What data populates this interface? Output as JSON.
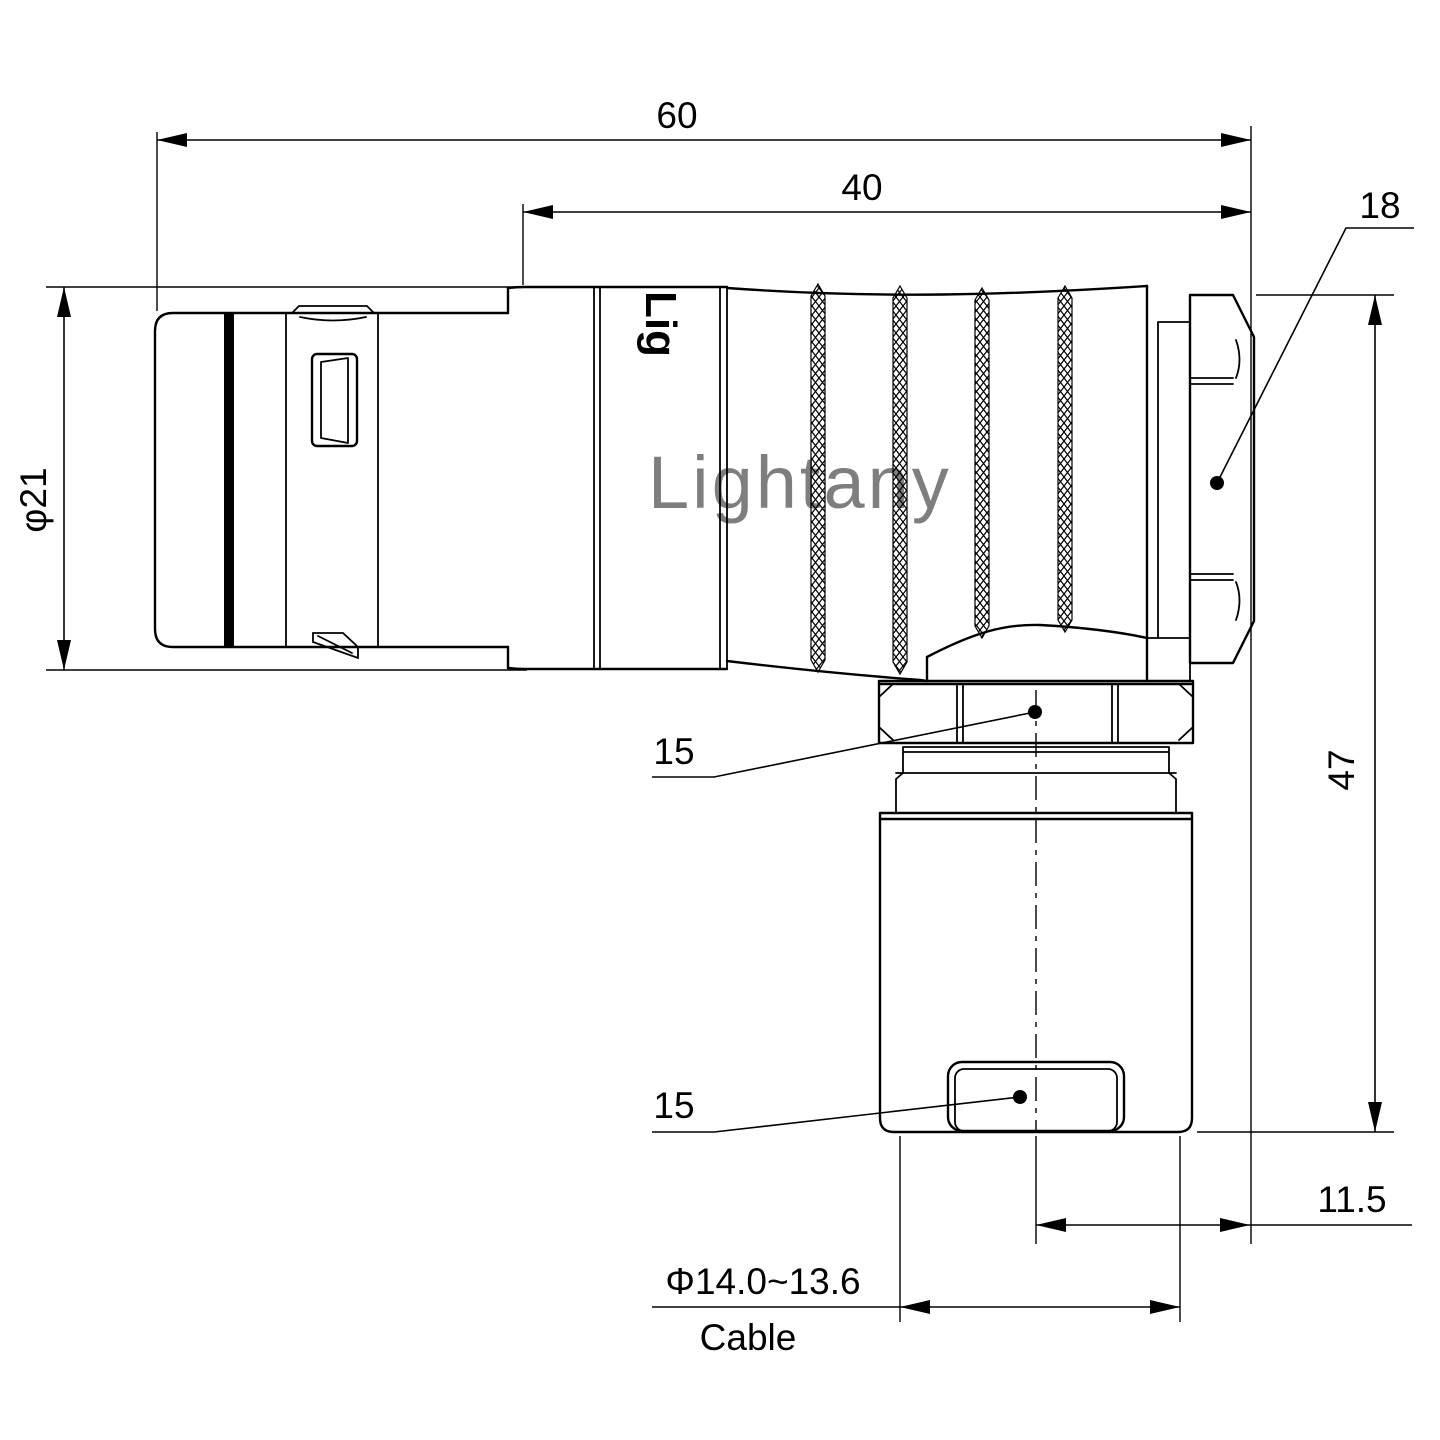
{
  "drawing": {
    "watermark": "Lightany",
    "body_stamp": "Lig",
    "colors": {
      "background": "#ffffff",
      "line": "#000000",
      "watermark": "#f5c6c6"
    },
    "dimensions": {
      "overall_length": "60",
      "rear_length": "40",
      "backnut_size": "18",
      "front_diameter": "φ21",
      "height": "47",
      "coupling_nut_size": "15",
      "bushing_size": "15",
      "cable_offset": "11.5",
      "cable_diameter": "Φ14.0~13.6",
      "cable_caption": "Cable"
    }
  }
}
